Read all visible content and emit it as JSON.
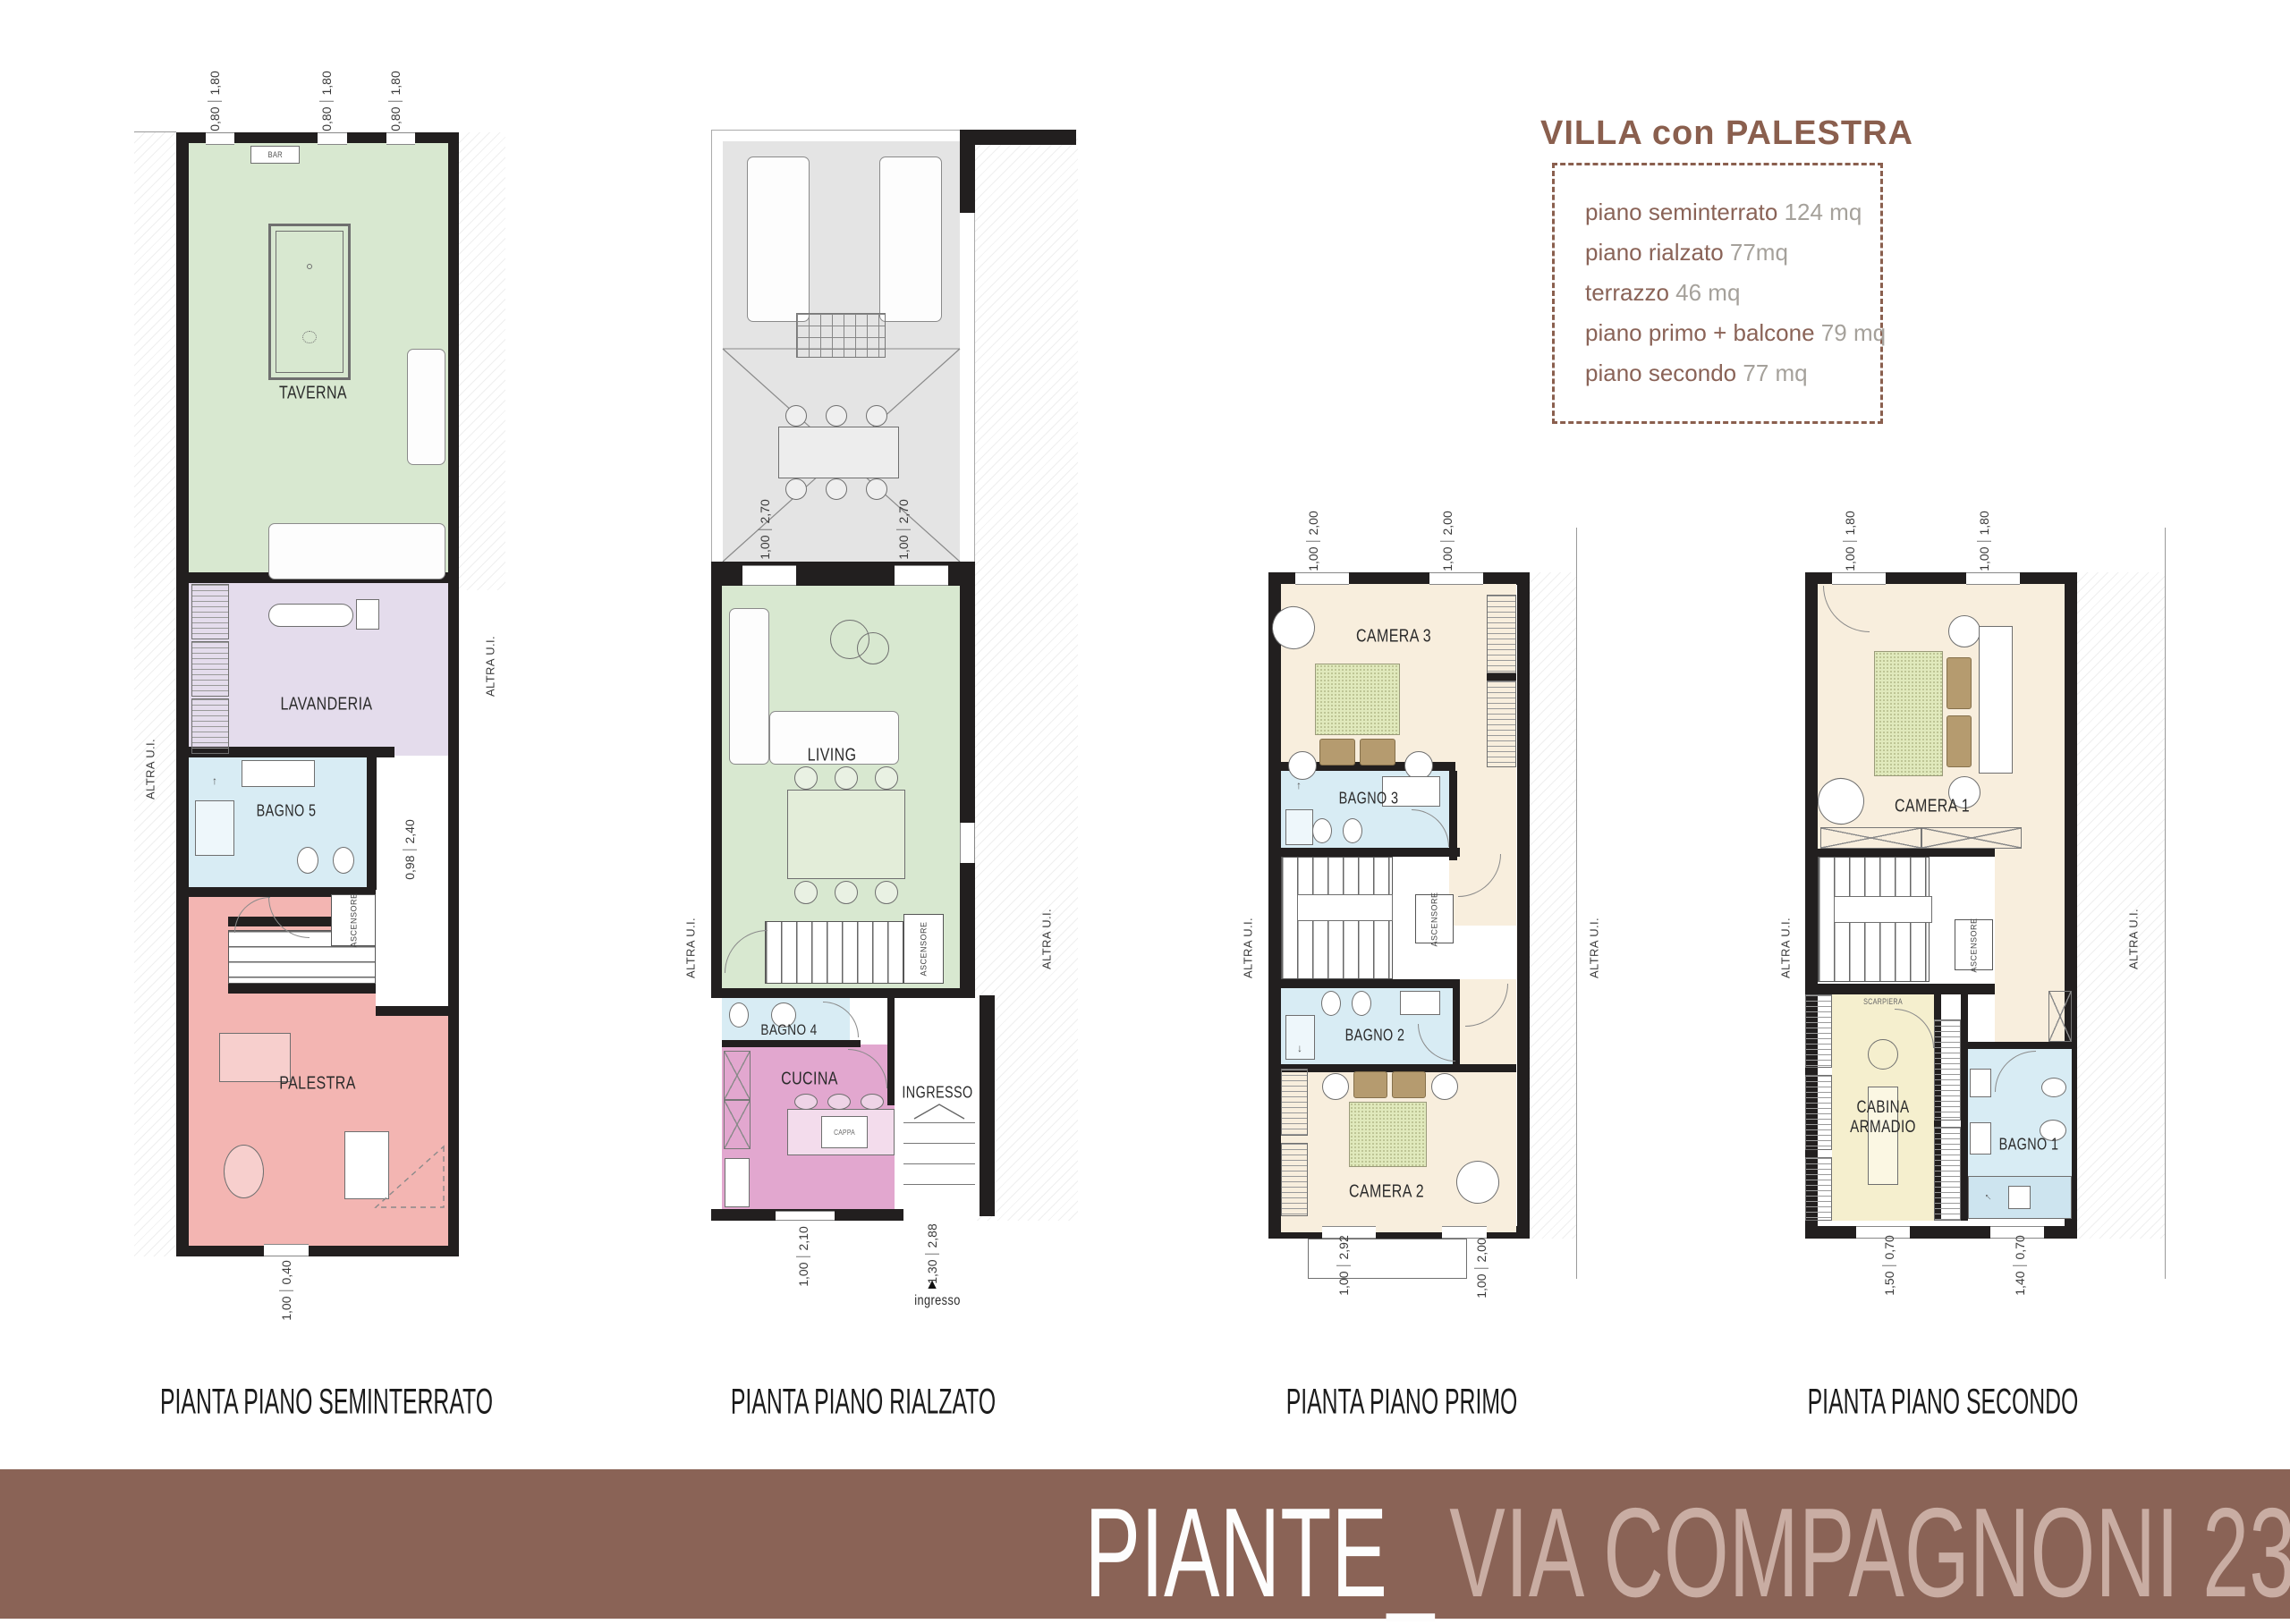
{
  "title_box": {
    "title": "VILLA con PALESTRA",
    "items": [
      {
        "label": "piano seminterrato",
        "value": "124 mq"
      },
      {
        "label": "piano rialzato",
        "value": "77mq"
      },
      {
        "label": "terrazzo",
        "value": "46 mq"
      },
      {
        "label": "piano primo + balcone",
        "value": "79 mq"
      },
      {
        "label": "piano secondo",
        "value": "77 mq"
      }
    ]
  },
  "banner": {
    "title": "PIANTE_",
    "subtitle": "VIA COMPAGNONI 23"
  },
  "shared": {
    "altra_ui": "ALTRA U.I.",
    "ascensore": "ASCENSORE"
  },
  "icons": {
    "up_arrow": "↑",
    "down_arrow": "↓",
    "entry_arrow": "▲"
  },
  "plans": [
    {
      "caption": "PIANTA PIANO SEMINTERRATO",
      "rooms": {
        "taverna": "TAVERNA",
        "lavanderia": "LAVANDERIA",
        "bagno5": "BAGNO 5",
        "palestra": "PALESTRA"
      },
      "labels": {
        "bar": "BAR"
      },
      "dims": [
        {
          "a": "0,80",
          "b": "1,80"
        },
        {
          "a": "0,80",
          "b": "1,80"
        },
        {
          "a": "0,80",
          "b": "1,80"
        },
        {
          "a": "0,98",
          "b": "2,40"
        },
        {
          "a": "1,00",
          "b": "0,40"
        }
      ]
    },
    {
      "caption": "PIANTA PIANO RIALZATO",
      "rooms": {
        "living": "LIVING",
        "bagno4": "BAGNO 4",
        "cucina": "CUCINA",
        "ingresso": "INGRESSO"
      },
      "labels": {
        "cappa": "CAPPA",
        "ingresso_entry": "ingresso"
      },
      "dims": [
        {
          "a": "1,00",
          "b": "2,70"
        },
        {
          "a": "1,00",
          "b": "2,70"
        },
        {
          "a": "1,00",
          "b": "2,10"
        },
        {
          "a": "1,30",
          "b": "2,88"
        }
      ]
    },
    {
      "caption": "PIANTA PIANO PRIMO",
      "rooms": {
        "camera3": "CAMERA 3",
        "bagno3": "BAGNO 3",
        "bagno2": "BAGNO 2",
        "camera2": "CAMERA 2"
      },
      "dims": [
        {
          "a": "1,00",
          "b": "2,00"
        },
        {
          "a": "1,00",
          "b": "2,00"
        },
        {
          "a": "1,00",
          "b": "2,92"
        },
        {
          "a": "1,00",
          "b": "2,00"
        }
      ]
    },
    {
      "caption": "PIANTA PIANO SECONDO",
      "rooms": {
        "camera1": "CAMERA 1",
        "cabina": "CABINA ARMADIO",
        "bagno1": "BAGNO 1"
      },
      "labels": {
        "scarpiera": "SCARPIERA"
      },
      "dims": [
        {
          "a": "1,00",
          "b": "1,80"
        },
        {
          "a": "1,00",
          "b": "1,80"
        },
        {
          "a": "1,50",
          "b": "0,70"
        },
        {
          "a": "1,40",
          "b": "0,70"
        }
      ]
    }
  ],
  "colors": {
    "banner_brown": "#8a6356",
    "title_brown": "#8a5f4e",
    "taverna_green": "#d8e8d0",
    "lavanderia_purple": "#e4dcec",
    "bagno_blue": "#d8ecf4",
    "palestra_pink": "#f3b5b2",
    "cucina_magenta": "#e2a7cf",
    "camera_cream": "#f8eedd",
    "cabina_yellow": "#f5efce",
    "terrace_gray": "#e4e4e4",
    "wall_black": "#221f1f"
  }
}
